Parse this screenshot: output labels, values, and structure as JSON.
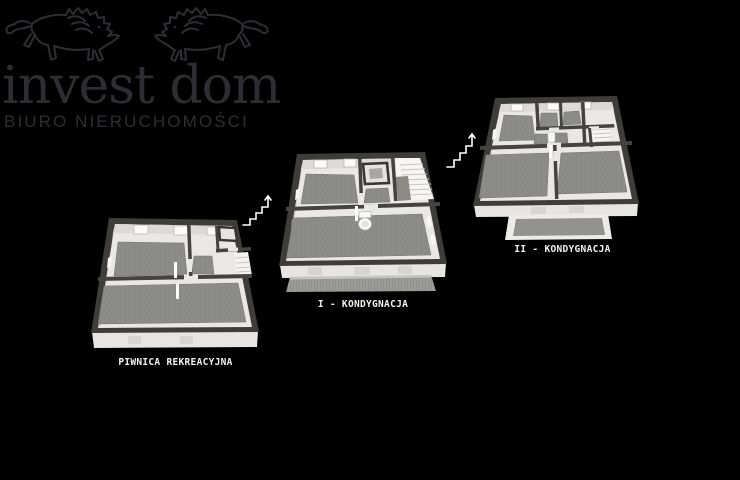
{
  "page": {
    "width": 740,
    "height": 480,
    "background_color": "#000000"
  },
  "logo": {
    "title": "invest dom",
    "subtitle": "BIURO NIERUCHOMOŚCI",
    "color": "#2e2e32",
    "icon": "two-mirrored-lions-line-art"
  },
  "floor_plans": [
    {
      "id": "piwnica",
      "label": "PIWNICA REKREACYJNA"
    },
    {
      "id": "kondygnacja-1",
      "label": "I - KONDYGNACJA"
    },
    {
      "id": "kondygnacja-2",
      "label": "II - KONDYGNACJA"
    }
  ],
  "stairs_icons": [
    {
      "id": "stairs-up-1",
      "icon": "staircase-with-up-arrow"
    },
    {
      "id": "stairs-up-2",
      "icon": "staircase-with-up-arrow"
    }
  ],
  "colors": {
    "label_text": "#f2f2f0",
    "outer_wall": "#3e3d3a",
    "interior_wall": "#44433f",
    "floor": "#e9e8e5",
    "carpet": "#8d8d89",
    "foundation": "#e6e5e2",
    "stairs_icon": "#ffffff"
  }
}
